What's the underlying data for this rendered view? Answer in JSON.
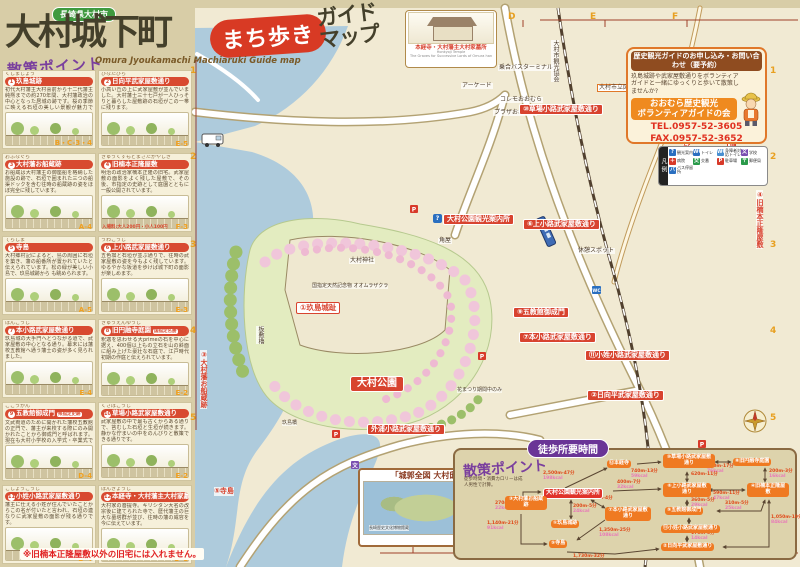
{
  "title": {
    "region": "長崎県大村市",
    "main": "大村城下町",
    "bubble": "まち歩き",
    "suffix1": "ガイド",
    "suffix2": "マップ",
    "subtitle": "Omura Jyoukamachi Machiaruki Guide map"
  },
  "sidebar": {
    "heading": "散策ポイント",
    "warning": "※旧楠本正隆屋敷以外の旧宅には入れません。",
    "items": [
      {
        "num": "1",
        "kana": "くしまじょう",
        "name": "玖島城跡",
        "grid": "B・C-3・4",
        "desc": "初代大村藩主大村喜前から十二代藩主純熈までの約270年間、大村藩政治の中心となった居城の跡です。桜の季節に映える石垣の美しい景観が魅力です。"
      },
      {
        "num": "2",
        "kana": "ひなたびら",
        "name": "日向平武家屋敷通り",
        "grid": "E-5",
        "desc": "小高い丘の上に武家屋敷が並んでいました。大村藩士三十七戸が一人ひっそりと暮らした屋敷跡の石垣がこの一帯に残ります。"
      },
      {
        "num": "3",
        "kana": "おふなぐら",
        "name": "大村藩お船蔵跡",
        "grid": "A-4",
        "desc": "お船蔵は大村藩主の御座船を格納した施設の跡で、石垣で囲まれた三つの船渠ドックを含む往時の船蔵跡の姿をほぼ完全に残しています。"
      },
      {
        "num": "4",
        "kana": "きゅうくすもとまさたかやしき",
        "name": "旧楠本正隆屋敷",
        "grid": "F-3",
        "desc": "明治の政治家楠本正隆の旧宅。武家屋敷の面影をよく残した屋敷で、その後、市指定の史跡として庭園とともに一般公開されています。",
        "fee": "入場料:大人200円・小人100円"
      },
      {
        "num": "5",
        "kana": "てらしま",
        "name": "寺島",
        "grid": "A-5",
        "desc": "大村郷村記によると、島の周囲に石垣を築き、藩の船番所が置かれていたと伝えられています。松の緑が美しい小島で、玖島城跡から も眺められます。"
      },
      {
        "num": "6",
        "kana": "うわこうじ",
        "name": "上小路武家屋敷通り",
        "grid": "E-3",
        "desc": "五色塀と石垣が並ぶ通りで、往時の武家屋敷の姿を今もよく残しています。ゆるやかな坂道を歩けば城下町の面影が楽しめます。"
      },
      {
        "num": "7",
        "kana": "ほんこうじ",
        "name": "本小路武家屋敷通り",
        "grid": "E-4",
        "desc": "玖島城の大手門へとつながる道で、武家屋敷の中心となる通り。幕末には藩校五教館へ通う藩士の姿が多く見られました。"
      },
      {
        "num": "8",
        "kana": "きゅうえんゆうじ",
        "name": "旧円融寺庭園",
        "tag": "国指定名勝",
        "grid": "E-2",
        "desc": "釈迦を思わせる大primeの石を中心に据え、400個以上もの立石を山の斜面に組み上げた豪壮な石庭で、江戸時代初期の作庭と伝えられています。"
      },
      {
        "num": "9",
        "kana": "ごこうかん",
        "name": "五教館御成門",
        "tag": "県指定史跡",
        "grid": "D-4",
        "desc": "文武両道のために開かれた藩校五教館の正門で、藩主が来校する際にのみ開かれたことから御成門と呼ばれます。現在も大村小学校の入学式・卒業式で開門されます。"
      },
      {
        "num": "10",
        "kana": "くさばこうじ",
        "name": "草場小路武家屋敷通り",
        "grid": "E-2",
        "desc": "武家屋敷の中で最も古くからある通りで、苔むした石垣と生垣が続きます。静かな佇まいの中をのんびりと散策できる通りです。"
      },
      {
        "num": "11",
        "kana": "こしょうこうじ",
        "name": "小姓小路武家屋敷通り",
        "grid": "D-4",
        "desc": "藩主に仕える小姓が住んでいたことからこの名が付いたと言われ、石垣の連なりに武家屋敷の面影が残る通りです。"
      },
      {
        "num": "12",
        "kana": "ほんきょうじ",
        "name": "本経寺・大村藩主大村家墓所",
        "tag": "国指定史跡",
        "grid": "D-1",
        "desc": "大村家の菩提寺。キリシタン大名の改宗後に建てられた寺で、歴代藩主の巨大な墓塔群が並び、往時の藩の威容を今に伝えています。"
      }
    ]
  },
  "contact": {
    "header": "歴史観光ガイドのお申し込み・お問い合わせ（要予約）",
    "body": "玖島城跡や武家屋敷通りをボランティアガイドと一緒にゆっくりと歩いて散策しませんか?",
    "org1": "おおむら歴史観光",
    "org2": "ボランティアガイドの会",
    "tel": "TEL.0957-52-3605",
    "fax": "FAX.0957-52-3652"
  },
  "legend": {
    "title": "凡例",
    "items": [
      {
        "icon": "?",
        "label": "観光案内",
        "color": "#2a6fc0"
      },
      {
        "icon": "WC",
        "label": "トイレ",
        "color": "#2a6fc0"
      },
      {
        "icon": "WC",
        "label": "身障者対応トイレ",
        "color": "#4a8fd0"
      },
      {
        "icon": "文",
        "label": "学校",
        "color": "#7a4fb0"
      },
      {
        "icon": "＋",
        "label": "病院",
        "color": "#d83a2a"
      },
      {
        "icon": "交",
        "label": "交番",
        "color": "#2a9a4a"
      },
      {
        "icon": "P",
        "label": "駐車場",
        "color": "#d83a2a"
      },
      {
        "icon": "〒",
        "label": "郵便局",
        "color": "#2a9a4a"
      },
      {
        "icon": "バ",
        "label": "バス停留所",
        "color": "#2a6fc0"
      }
    ]
  },
  "inset": {
    "label": "本経寺・大村藩主大村家墓所",
    "en1": "Honkyoji Temple",
    "en2": "The Graves for Successive Lords of Omura han"
  },
  "paint": {
    "header": "「城郭全図 大村邸」",
    "era": "明治初期",
    "credit": "長崎歴史文化博物館蔵"
  },
  "map": {
    "labels": [
      {
        "text": "①玖島城趾"
      },
      {
        "text": "大村公園"
      },
      {
        "text": "大村公園観光案内所"
      },
      {
        "text": "大村神社"
      },
      {
        "text": "国指定天然記念物 オオムラザクラ"
      },
      {
        "text": "板敷櫓"
      },
      {
        "text": "③大村藩お船蔵跡"
      },
      {
        "text": "⑤寺島"
      },
      {
        "text": "乗合バスターミナル"
      },
      {
        "text": "アーケード"
      },
      {
        "text": "コレモおおむら"
      },
      {
        "text": "プラザおおむら"
      },
      {
        "text": "大村市立図書館・史料館"
      },
      {
        "text": "⑩草場小路武家屋敷通り"
      },
      {
        "text": "旧長崎街道"
      },
      {
        "text": "⑧旧円融寺庭園"
      },
      {
        "text": "④旧楠本正隆屋敷"
      },
      {
        "text": "⑥上小路武家屋敷通り"
      },
      {
        "text": "休憩スポット"
      },
      {
        "text": "角屋"
      },
      {
        "text": "⑨五教館御成門"
      },
      {
        "text": "⑦本小路武家屋敷通り"
      },
      {
        "text": "⑪小姓小路武家屋敷通り"
      },
      {
        "text": "②日向平武家屋敷通り"
      },
      {
        "text": "外浦小路武家屋敷通り"
      },
      {
        "text": "花まつり期間中のみ"
      },
      {
        "text": "玖島橋"
      },
      {
        "text": "大村市観光協会"
      }
    ]
  },
  "walk": {
    "bubble": "徒歩所要時間",
    "heading": "散策ポイント",
    "note": "徒歩時間・消費カロリーは成人男性で計算。",
    "nodes": [
      {
        "label": "大村公園観光案内所"
      },
      {
        "label": "⑫本経寺"
      },
      {
        "label": "⑩草場小路武家屋敷通り"
      },
      {
        "label": "⑧旧円融寺庭園"
      },
      {
        "label": "⑥上小路武家屋敷通り"
      },
      {
        "label": "④旧楠本正隆屋敷"
      },
      {
        "label": "⑨五教館御成門"
      },
      {
        "label": "⑪小姓小路武家屋敷通り"
      },
      {
        "label": "②日向平武家屋敷通り"
      },
      {
        "label": "③大村藩お船蔵跡"
      },
      {
        "label": "①玖島城跡"
      },
      {
        "label": "⑤寺島"
      },
      {
        "label": "⑦本小路武家屋敷通り"
      }
    ],
    "edges": [
      {
        "dist": "2,500m-47分",
        "kcal": "198kcal"
      },
      {
        "dist": "740m-13分",
        "kcal": "59kcal"
      },
      {
        "dist": "960m-17分",
        "kcal": "76kcal"
      },
      {
        "dist": "200m-3分",
        "kcal": "16kcal"
      },
      {
        "dist": "620m-11分",
        "kcal": "50kcal"
      },
      {
        "dist": "400m-7分",
        "kcal": "32kcal"
      },
      {
        "dist": "590m-11分",
        "kcal": "47kcal"
      },
      {
        "dist": "360m-5分",
        "kcal": "29kcal"
      },
      {
        "dist": "310m-5分",
        "kcal": "25kcal"
      },
      {
        "dist": "170m-3分",
        "kcal": "14kcal"
      },
      {
        "dist": "1,050m-19分",
        "kcal": "84kcal"
      },
      {
        "dist": "200m-5分",
        "kcal": "24kcal"
      },
      {
        "dist": "270m-5分",
        "kcal": "22kcal"
      },
      {
        "dist": "1,140m-21分",
        "kcal": "91kcal"
      },
      {
        "dist": "240m-4分",
        "kcal": "19kcal"
      },
      {
        "dist": "1,350m-25分",
        "kcal": "108kcal"
      },
      {
        "dist": "1,730m-32分",
        "kcal": "138kcal"
      }
    ]
  },
  "grid": {
    "top": [
      "D",
      "E",
      "F"
    ],
    "bottom": [
      "C"
    ],
    "right": [
      "1",
      "2",
      "3",
      "4",
      "5"
    ],
    "left": [
      "1",
      "2",
      "3",
      "4",
      "5"
    ]
  }
}
